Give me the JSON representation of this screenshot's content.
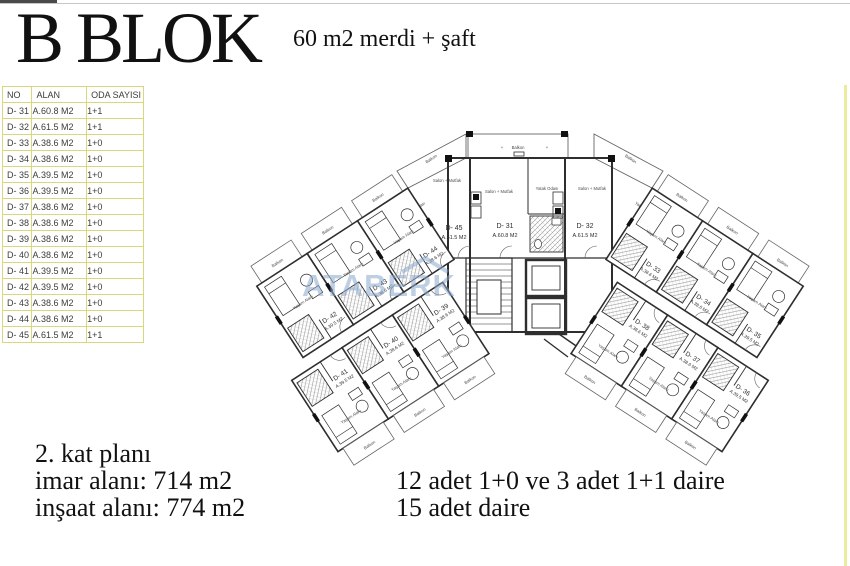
{
  "header": {
    "title": "B BLOK",
    "subtitle": "60 m2  merdi + şaft"
  },
  "table": {
    "headers": [
      "NO",
      "ALAN",
      "ODA SAYISI"
    ],
    "rows": [
      {
        "no": "D- 31",
        "alan": "A.60.8 M2",
        "oda": "1+1"
      },
      {
        "no": "D- 32",
        "alan": "A.61.5 M2",
        "oda": "1+1"
      },
      {
        "no": "D- 33",
        "alan": "A.38.6 M2",
        "oda": "1+0"
      },
      {
        "no": "D- 34",
        "alan": "A.38.6 M2",
        "oda": "1+0"
      },
      {
        "no": "D- 35",
        "alan": "A.39.5 M2",
        "oda": "1+0"
      },
      {
        "no": "D- 36",
        "alan": "A.39.5 M2",
        "oda": "1+0"
      },
      {
        "no": "D- 37",
        "alan": "A.38.6 M2",
        "oda": "1+0"
      },
      {
        "no": "D- 38",
        "alan": "A.38.6 M2",
        "oda": "1+0"
      },
      {
        "no": "D- 39",
        "alan": "A.38.6 M2",
        "oda": "1+0"
      },
      {
        "no": "D- 40",
        "alan": "A.38.6 M2",
        "oda": "1+0"
      },
      {
        "no": "D- 41",
        "alan": "A.39.5 M2",
        "oda": "1+0"
      },
      {
        "no": "D- 42",
        "alan": "A.39.5 M2",
        "oda": "1+0"
      },
      {
        "no": "D- 43",
        "alan": "A.38.6 M2",
        "oda": "1+0"
      },
      {
        "no": "D- 44",
        "alan": "A.38.6 M2",
        "oda": "1+0"
      },
      {
        "no": "D- 45",
        "alan": "A.61.5 M2",
        "oda": "1+1"
      }
    ]
  },
  "plan": {
    "watermark": "ATABERK",
    "labels": {
      "balkon": "Balkon",
      "salon_mutfak": "Salon + Mutfak",
      "yatak_odasi": "Yatak Odası",
      "yasam_alani": "Yaşam Alanı"
    },
    "center_units": [
      {
        "id": "D- 45",
        "area": "A.61.5 M2"
      },
      {
        "id": "D- 31",
        "area": "A.60.8 M2"
      },
      {
        "id": "D- 32",
        "area": "A.61.5 M2"
      }
    ],
    "wing_units": [
      {
        "id": "D- 44",
        "area": "A.38.6 M2"
      },
      {
        "id": "D- 43",
        "area": "A.38.6 M2"
      },
      {
        "id": "D- 42",
        "area": "A.39.5 M2"
      },
      {
        "id": "D- 39",
        "area": "A.38.6 M2"
      },
      {
        "id": "D- 40",
        "area": "A.38.6 M2"
      },
      {
        "id": "D- 41",
        "area": "A.39.5 M2"
      },
      {
        "id": "D- 33",
        "area": "A.38.6 M2"
      },
      {
        "id": "D- 34",
        "area": "A.38.6 M2"
      },
      {
        "id": "D- 35",
        "area": "A.39.5 M2"
      },
      {
        "id": "D- 38",
        "area": "A.38.6 M2"
      },
      {
        "id": "D- 37",
        "area": "A.38.6 M2"
      },
      {
        "id": "D- 36",
        "area": "A.39.5 M2"
      }
    ]
  },
  "footer": {
    "floor": "2. kat planı",
    "imar": "imar alanı: 714 m2",
    "insaat": "inşaat alanı: 774 m2",
    "mix": "12 adet 1+0 ve 3 adet 1+1 daire",
    "total": "15 adet daire"
  },
  "colors": {
    "table_border": "#d9d77e",
    "watermark_blue": "#8aa8cd",
    "plan_line": "#2e2e2e",
    "page_edge_yellow": "#ececa0"
  }
}
